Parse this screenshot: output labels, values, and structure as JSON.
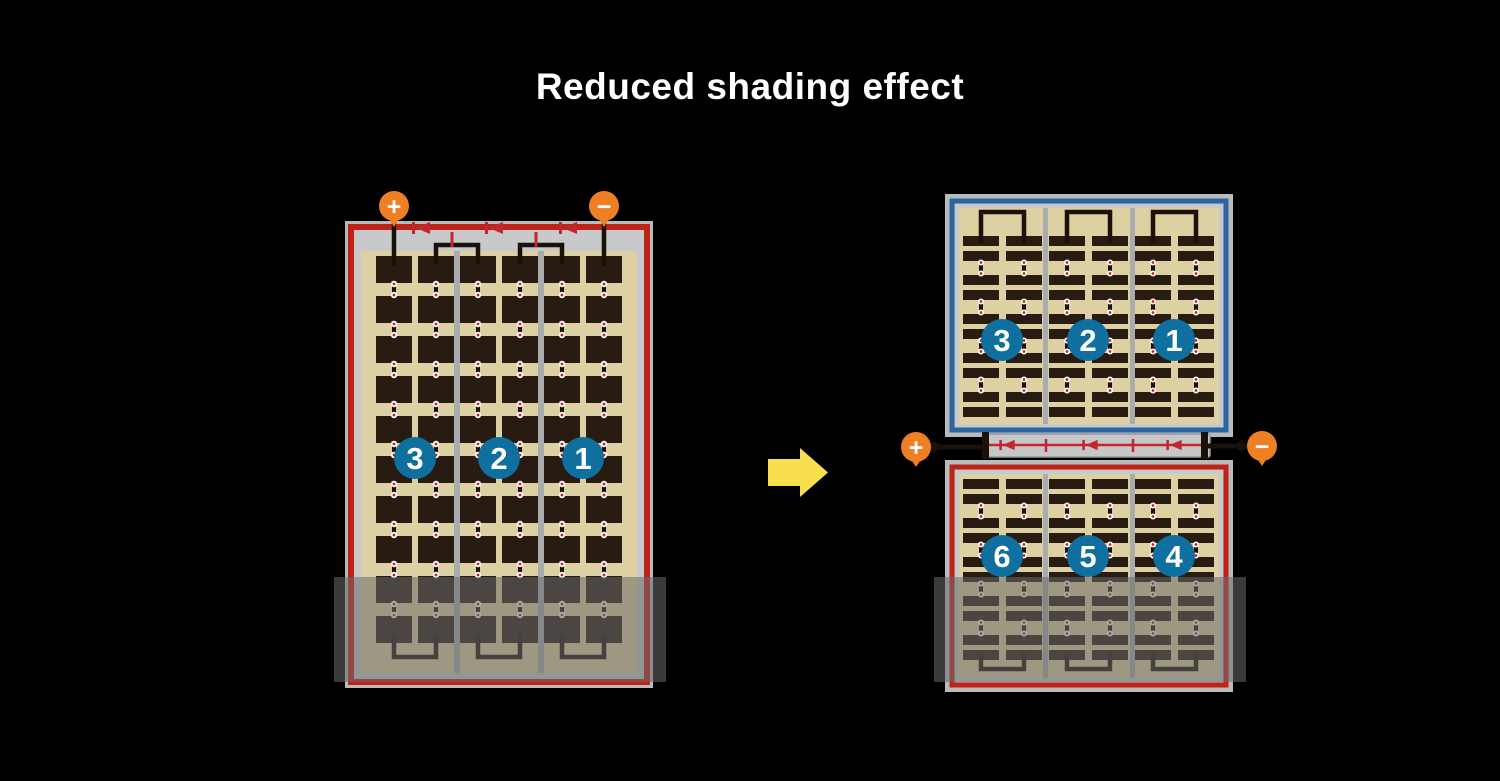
{
  "title": "Reduced shading effect",
  "left_panel": {
    "terminal_positive": "+",
    "terminal_negative": "−",
    "modules": [
      "3",
      "2",
      "1"
    ],
    "bypass_diode_count": 3
  },
  "right_panel": {
    "terminal_positive": "+",
    "terminal_negative": "−",
    "top_half_modules": [
      "3",
      "2",
      "1"
    ],
    "bottom_half_modules": [
      "6",
      "5",
      "4"
    ],
    "bypass_diode_count": 3
  },
  "icons": {
    "transform_arrow": "arrow-right",
    "bypass_diode": "diode-arrow-left",
    "positive_terminal": "plus-badge",
    "negative_terminal": "minus-badge"
  },
  "colors": {
    "background": "#000000",
    "title_text": "#ffffff",
    "panel_frame": "#b9babc",
    "panel_inner": "#c8c9cb",
    "cell_field_tan": "#ddd0a2",
    "cell_dark": "#281c12",
    "group_separator": "#a9abad",
    "red_frame": "#bf2318",
    "diode_red": "#c1272d",
    "blue_frame": "#2b66a3",
    "module_badge_blue": "#0f6f9e",
    "terminal_orange": "#ee7f22",
    "busbar_black": "#1a110b",
    "arrow_yellow": "#f8df4e",
    "dot_white": "#ffffff",
    "dot_red": "#cc2020",
    "shading_overlay": "rgba(105,105,105,0.55)"
  }
}
